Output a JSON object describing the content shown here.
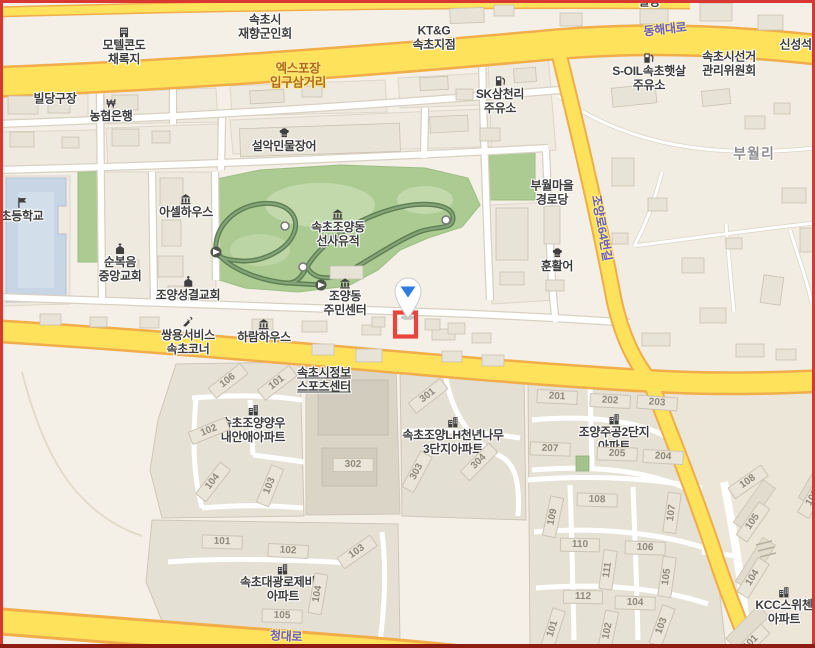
{
  "map": {
    "colors": {
      "background": "#F4F0E7",
      "major_road": "#FFE25C",
      "major_road_casing": "#F0AD49",
      "minor_road": "#FFFFFF",
      "park": "#ABCB92",
      "trail": "#5E7E54",
      "school": "#C8D5E5",
      "building": "#E8E3D7",
      "marker_blue": "#2F7CE0",
      "highlight_red": "#E8463C",
      "frame_red": "#D93732",
      "road_label_purple": "#6B5EC4",
      "junction_label_brown": "#B06A1E"
    },
    "marker": {
      "x": 408,
      "y": 292,
      "style": "white-pin-blue-arrow"
    },
    "highlighted_building": {
      "x": 395,
      "y": 312,
      "w": 21,
      "h": 24
    },
    "labels": [
      {
        "name": "label-partial-building",
        "type": "poi",
        "lines": [
          "빌딩"
        ],
        "x": 649,
        "y": 2
      },
      {
        "name": "label-sokcho-veterans-assoc",
        "type": "poi",
        "lines": [
          "속초시",
          "재향군인회"
        ],
        "x": 265,
        "y": 27
      },
      {
        "name": "label-motel-condo-chaerokji",
        "type": "poi",
        "icon": "hotel",
        "lines": [
          "모텔콘도",
          "채록지"
        ],
        "x": 124,
        "y": 46
      },
      {
        "name": "label-ktng-sokcho",
        "type": "poi",
        "lines": [
          "KT&G",
          "속초지점"
        ],
        "x": 434,
        "y": 38
      },
      {
        "name": "label-donghae-daero",
        "type": "road",
        "lines": [
          "동해대로"
        ],
        "x": 665,
        "y": 30,
        "rot": -6
      },
      {
        "name": "label-expo-entrance-junction",
        "type": "roadbrown",
        "lines": [
          "엑스포장",
          "입구삼거리"
        ],
        "x": 298,
        "y": 76
      },
      {
        "name": "label-shinseong-stone",
        "type": "poi",
        "lines": [
          "신성석재"
        ],
        "x": 801,
        "y": 45
      },
      {
        "name": "label-soil-gas-station",
        "type": "poi",
        "icon": "gas",
        "lines": [
          "S-OIL속초햇살",
          "주유소"
        ],
        "x": 649,
        "y": 72
      },
      {
        "name": "label-election-commission",
        "type": "poi",
        "lines": [
          "속초시선거",
          "관리위원회"
        ],
        "x": 729,
        "y": 64
      },
      {
        "name": "label-sk-gas-station",
        "type": "poi",
        "icon": "gas",
        "lines": [
          "SK삼천리",
          "주유소"
        ],
        "x": 500,
        "y": 95
      },
      {
        "name": "label-billiards",
        "type": "poi",
        "lines": [
          "빌당구장"
        ],
        "x": 55,
        "y": 99
      },
      {
        "name": "label-nonghyup-bank",
        "type": "poi",
        "icon": "bank",
        "lines": [
          "농협은행"
        ],
        "x": 111,
        "y": 110
      },
      {
        "name": "label-seorak-eel-restaurant",
        "type": "poi",
        "icon": "restaurant",
        "lines": [
          "설악민물장어"
        ],
        "x": 284,
        "y": 140
      },
      {
        "name": "label-buwol-ri",
        "type": "area",
        "lines": [
          "부월리"
        ],
        "x": 754,
        "y": 154
      },
      {
        "name": "label-buwol-senior-hall",
        "type": "poi",
        "lines": [
          "부월마을",
          "경로당"
        ],
        "x": 552,
        "y": 193
      },
      {
        "name": "label-joyangro-64beongil",
        "type": "road",
        "lines": [
          "조양로64번길"
        ],
        "x": 601,
        "y": 228,
        "rot": 80
      },
      {
        "name": "label-hun-hwaleo",
        "type": "poi",
        "icon": "restaurant",
        "lines": [
          "훈활어"
        ],
        "x": 557,
        "y": 260
      },
      {
        "name": "label-asel-house",
        "type": "poi",
        "icon": "lodging",
        "lines": [
          "아셀하우스"
        ],
        "x": 186,
        "y": 206
      },
      {
        "name": "label-elementary-school",
        "type": "poi",
        "icon": "school",
        "lines": [
          "초등학교"
        ],
        "x": 22,
        "y": 210
      },
      {
        "name": "label-sunbokeum-church",
        "type": "poi",
        "icon": "church",
        "lines": [
          "순복음",
          "중앙교회"
        ],
        "x": 120,
        "y": 263
      },
      {
        "name": "label-joyang-songgyeol-church",
        "type": "poi",
        "icon": "church",
        "lines": [
          "조양성결교회"
        ],
        "x": 188,
        "y": 289
      },
      {
        "name": "label-prehistoric-site",
        "type": "poi",
        "icon": "museum",
        "lines": [
          "속초조양동",
          "선사유적"
        ],
        "x": 338,
        "y": 228
      },
      {
        "name": "label-joyangdong-community-center",
        "type": "poi",
        "icon": "gov",
        "lines": [
          "조양동",
          "주민센터"
        ],
        "x": 345,
        "y": 297
      },
      {
        "name": "label-ssangyong-service",
        "type": "poi",
        "icon": "wrench",
        "lines": [
          "쌍용서비스",
          "속초코너"
        ],
        "x": 188,
        "y": 336
      },
      {
        "name": "label-haram-house",
        "type": "poi",
        "icon": "lodging",
        "lines": [
          "하람하우스"
        ],
        "x": 264,
        "y": 331
      },
      {
        "name": "label-sokcho-info-sports-center",
        "type": "poi",
        "underline": true,
        "lines": [
          "속초시정보",
          "스포츠센터"
        ],
        "x": 324,
        "y": 380
      },
      {
        "name": "label-naeanae-apt",
        "type": "poi",
        "icon": "apartment",
        "lines": [
          "속초조양양우",
          "내안애아파트"
        ],
        "x": 253,
        "y": 424
      },
      {
        "name": "label-lh-3danji-apt",
        "type": "poi",
        "icon": "apartment",
        "lines": [
          "속초조양LH천년나무",
          "3단지아파트"
        ],
        "x": 453,
        "y": 436
      },
      {
        "name": "label-jugong-2danji-apt",
        "type": "poi",
        "icon": "apartment",
        "lines": [
          "조양주공2단지",
          "아파트"
        ],
        "x": 614,
        "y": 433
      },
      {
        "name": "label-kcc-switzen-apt",
        "type": "poi",
        "icon": "apartment",
        "lines": [
          "KCC스위첸",
          "아파트"
        ],
        "x": 784,
        "y": 606
      },
      {
        "name": "label-daegwang-apt",
        "type": "poi",
        "icon": "apartment",
        "lines": [
          "속초대광로제비앙",
          "아파트"
        ],
        "x": 283,
        "y": 583
      },
      {
        "name": "label-cheongdae-ro",
        "type": "road",
        "lines": [
          "청대로"
        ],
        "x": 286,
        "y": 637,
        "rot": 3
      },
      {
        "name": "building-number",
        "type": "num",
        "lines": [
          "106"
        ],
        "x": 228,
        "y": 381,
        "rot": -38
      },
      {
        "name": "building-number",
        "type": "num",
        "lines": [
          "101"
        ],
        "x": 277,
        "y": 383,
        "rot": -38
      },
      {
        "name": "building-number",
        "type": "num",
        "lines": [
          "102"
        ],
        "x": 209,
        "y": 431,
        "rot": -22
      },
      {
        "name": "building-number",
        "type": "num",
        "lines": [
          "104"
        ],
        "x": 213,
        "y": 482,
        "rot": -52
      },
      {
        "name": "building-number",
        "type": "num",
        "lines": [
          "103"
        ],
        "x": 270,
        "y": 486,
        "rot": -68
      },
      {
        "name": "building-number",
        "type": "num",
        "lines": [
          "301"
        ],
        "x": 428,
        "y": 396,
        "rot": -38
      },
      {
        "name": "building-number",
        "type": "num",
        "lines": [
          "302"
        ],
        "x": 353,
        "y": 465,
        "rot": 0
      },
      {
        "name": "building-number",
        "type": "num",
        "lines": [
          "303"
        ],
        "x": 417,
        "y": 472,
        "rot": -62
      },
      {
        "name": "building-number",
        "type": "num",
        "lines": [
          "304"
        ],
        "x": 479,
        "y": 462,
        "rot": -45
      },
      {
        "name": "building-number",
        "type": "num",
        "lines": [
          "201"
        ],
        "x": 557,
        "y": 397,
        "rot": 3
      },
      {
        "name": "building-number",
        "type": "num",
        "lines": [
          "202"
        ],
        "x": 610,
        "y": 401,
        "rot": 3
      },
      {
        "name": "building-number",
        "type": "num",
        "lines": [
          "203"
        ],
        "x": 657,
        "y": 403,
        "rot": 4
      },
      {
        "name": "building-number",
        "type": "num",
        "lines": [
          "207"
        ],
        "x": 550,
        "y": 449,
        "rot": 2
      },
      {
        "name": "building-number",
        "type": "num",
        "lines": [
          "205"
        ],
        "x": 617,
        "y": 454,
        "rot": 2
      },
      {
        "name": "building-number",
        "type": "num",
        "lines": [
          "204"
        ],
        "x": 663,
        "y": 457,
        "rot": 3
      },
      {
        "name": "building-number",
        "type": "num",
        "lines": [
          "108"
        ],
        "x": 597,
        "y": 500,
        "rot": 2
      },
      {
        "name": "building-number",
        "type": "num",
        "lines": [
          "109"
        ],
        "x": 553,
        "y": 517,
        "rot": -78
      },
      {
        "name": "building-number",
        "type": "num",
        "lines": [
          "107"
        ],
        "x": 672,
        "y": 513,
        "rot": -82
      },
      {
        "name": "building-number",
        "type": "num",
        "lines": [
          "110"
        ],
        "x": 580,
        "y": 545,
        "rot": 1
      },
      {
        "name": "building-number",
        "type": "num",
        "lines": [
          "106"
        ],
        "x": 645,
        "y": 548,
        "rot": 2
      },
      {
        "name": "building-number",
        "type": "num",
        "lines": [
          "111"
        ],
        "x": 608,
        "y": 570,
        "rot": -82
      },
      {
        "name": "building-number",
        "type": "num",
        "lines": [
          "105"
        ],
        "x": 667,
        "y": 577,
        "rot": -82
      },
      {
        "name": "building-number",
        "type": "num",
        "lines": [
          "112"
        ],
        "x": 583,
        "y": 597,
        "rot": 1
      },
      {
        "name": "building-number",
        "type": "num",
        "lines": [
          "104"
        ],
        "x": 635,
        "y": 603,
        "rot": 2
      },
      {
        "name": "building-number",
        "type": "num",
        "lines": [
          "101"
        ],
        "x": 553,
        "y": 629,
        "rot": -72
      },
      {
        "name": "building-number",
        "type": "num",
        "lines": [
          "102"
        ],
        "x": 608,
        "y": 631,
        "rot": -78
      },
      {
        "name": "building-number",
        "type": "num",
        "lines": [
          "103"
        ],
        "x": 662,
        "y": 626,
        "rot": -70
      },
      {
        "name": "building-number",
        "type": "num",
        "lines": [
          "108"
        ],
        "x": 748,
        "y": 482,
        "rot": -35
      },
      {
        "name": "building-number",
        "type": "num",
        "lines": [
          "105"
        ],
        "x": 753,
        "y": 522,
        "rot": -55
      },
      {
        "name": "building-number",
        "type": "num",
        "lines": [
          "104"
        ],
        "x": 753,
        "y": 578,
        "rot": -58
      },
      {
        "name": "building-number",
        "type": "num",
        "lines": [
          "101"
        ],
        "x": 751,
        "y": 643,
        "rot": -45
      },
      {
        "name": "building-number",
        "type": "num",
        "lines": [
          "105"
        ],
        "x": 813,
        "y": 498,
        "rot": -60
      },
      {
        "name": "building-number",
        "type": "num",
        "lines": [
          "101"
        ],
        "x": 222,
        "y": 542,
        "rot": 2
      },
      {
        "name": "building-number",
        "type": "num",
        "lines": [
          "102"
        ],
        "x": 288,
        "y": 551,
        "rot": 3
      },
      {
        "name": "building-number",
        "type": "num",
        "lines": [
          "103"
        ],
        "x": 357,
        "y": 552,
        "rot": -35
      },
      {
        "name": "building-number",
        "type": "num",
        "lines": [
          "104"
        ],
        "x": 318,
        "y": 594,
        "rot": -80
      },
      {
        "name": "building-number",
        "type": "num",
        "lines": [
          "105"
        ],
        "x": 282,
        "y": 616,
        "rot": 2
      }
    ]
  }
}
